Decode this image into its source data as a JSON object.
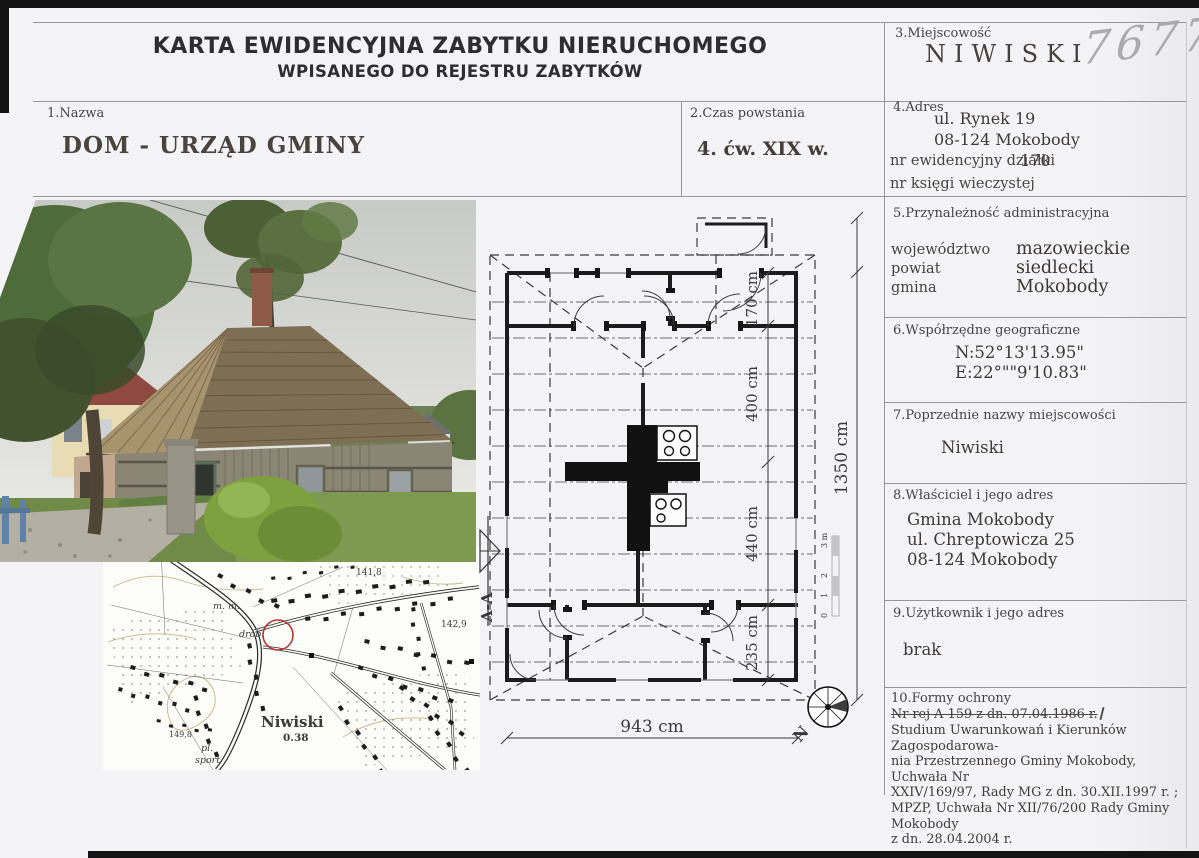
{
  "header": {
    "title_line1": "KARTA EWIDENCYJNA ZABYTKU NIERUCHOMEGO",
    "title_line2": "WPISANEGO DO REJESTRU ZABYTKÓW",
    "handwritten_number": "7677"
  },
  "fields": {
    "nazwa": {
      "label": "1.Nazwa",
      "value": "DOM - URZĄD GMINY"
    },
    "czas_powstania": {
      "label": "2.Czas powstania",
      "value": "4. ćw. XIX w."
    },
    "miejscowosc": {
      "label": "3.Miejscowość",
      "value": "NIWISKI"
    },
    "adres": {
      "label": "4.Adres",
      "line1": "ul. Rynek 19",
      "line2": "08-124 Mokobody",
      "dzialka_label": "nr ewidencyjny działki",
      "dzialka_value": "170",
      "ksiega_label": "nr księgi wieczystej"
    },
    "przynaleznosc": {
      "label": "5.Przynależność administracyjna",
      "rows": [
        {
          "k": "województwo",
          "v": "mazowieckie"
        },
        {
          "k": "powiat",
          "v": "siedlecki"
        },
        {
          "k": "gmina",
          "v": "Mokobody"
        }
      ]
    },
    "wspolrzedne": {
      "label": "6.Współrzędne geograficzne",
      "n": "N:52°13'13.95\"",
      "e": "E:22°\"\"9'10.83\""
    },
    "poprzednie_nazwy": {
      "label": "7.Poprzednie nazwy miejscowości",
      "value": "Niwiski"
    },
    "wlasciciel": {
      "label": "8.Właściciel i jego adres",
      "lines": [
        "Gmina Mokobody",
        "ul. Chreptowicza 25",
        "08-124 Mokobody"
      ]
    },
    "uzytkownik": {
      "label": "9.Użytkownik i jego adres",
      "value": "brak"
    },
    "formy_ochrony": {
      "label": "10.Formy ochrony",
      "struck": "Nr rej A-159 z dn. 07.04.1986 r.",
      "lines": [
        "Studium Uwarunkowań i Kierunków Zagospodarowa-",
        "nia Przestrzennego Gminy Mokobody, Uchwała Nr",
        "XXIV/169/97, Rady MG z dn. 30.XII.1997 r. ;",
        "MPZP, Uchwała Nr XII/76/200 Rady Gminy Mokobody",
        "z dn. 28.04.2004 r."
      ]
    }
  },
  "plan": {
    "dim_170": "170 cm",
    "dim_400": "400 cm",
    "dim_440": "440 cm",
    "dim_235": "235 cm",
    "dim_1350": "1350 cm",
    "dim_943": "943 cm",
    "section_marker": "A-A",
    "north_label": "N",
    "scale": {
      "m3": "3 m",
      "m2": "2",
      "m1": "1",
      "m0": "0"
    }
  },
  "map": {
    "place_name": "Niwiski",
    "place_area": "0.38",
    "elevation_1": "141,8",
    "elevation_2": "142,9",
    "elevation_3": "149,8",
    "note_1": "m. m.",
    "note_2": "drób.",
    "note_3": "pl.",
    "note_4": "sport"
  },
  "colors": {
    "page": "#f4f4f6",
    "ink": "#3c3c3e",
    "pencil": "#ababaf",
    "map_marker_red": "#b5382e",
    "plan_wall": "#1c1c1c"
  }
}
